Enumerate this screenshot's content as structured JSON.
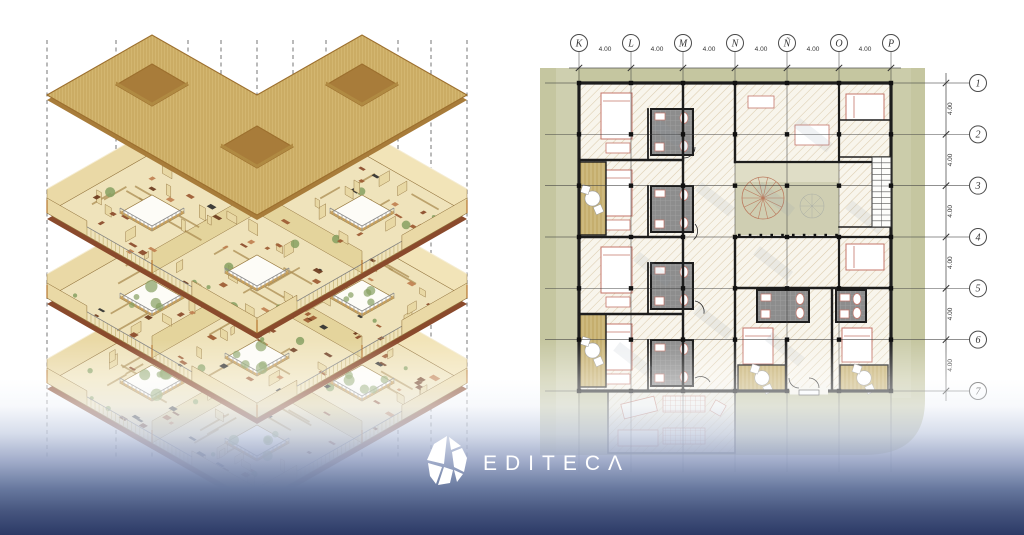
{
  "brand": {
    "wordmark": "EDITECΛ",
    "icon": "editeca-gem"
  },
  "plan": {
    "column_labels": [
      "K",
      "L",
      "M",
      "N",
      "Ñ",
      "O",
      "P"
    ],
    "row_labels": [
      "1",
      "2",
      "3",
      "4",
      "5",
      "6",
      "7"
    ],
    "column_spacing_label": "4.00",
    "row_spacing_label": "4.00"
  },
  "axon": {
    "floor_levels": 3,
    "has_roof_plate": true
  },
  "colors": {
    "site": "#c5c6a0",
    "siteLight": "#d6d7bc",
    "floorBg": "#f8f5ec",
    "hatchLine": "#dcccae",
    "wall": "#1d1d1d",
    "bath": "#8d8d8d",
    "bathLine": "#a3a3a3",
    "deck": "#cdb97e",
    "deckLine": "#bda45e",
    "fixture": "#c4766a",
    "courtyard": "#cfceb2",
    "courtyardLight": "#dfddc6",
    "stairRed": "#bb7a5e",
    "gridline": "#3c3c3c",
    "bubbleStroke": "#4a4a4a",
    "dimText": "#333333",
    "shadow": "#8d97aa",
    "roof": "#d3b670",
    "roofHatchLine": "#c2a156",
    "roofEdge": "#9c6f2e",
    "roofSide": "#a87c3a",
    "slabSide": "#8a4a2c",
    "holeRim": "#b08a42",
    "floorTop": "#efe3bb",
    "wallCream": "#ead9a6",
    "wallCreamLight": "#f2e4b8",
    "wallStroke": "#8a6a34",
    "wood": "#b5762f",
    "railTick": "#c9b678",
    "railTop": "#808080",
    "dash": "#666666",
    "furniture": [
      "#6b3a1d",
      "#2f2f2f",
      "#9c5a32",
      "#8a4a2a",
      "#c08050"
    ],
    "plant": "#86a061",
    "gradientEnd": "#2c3a66",
    "logoWhite": "#ffffff"
  }
}
